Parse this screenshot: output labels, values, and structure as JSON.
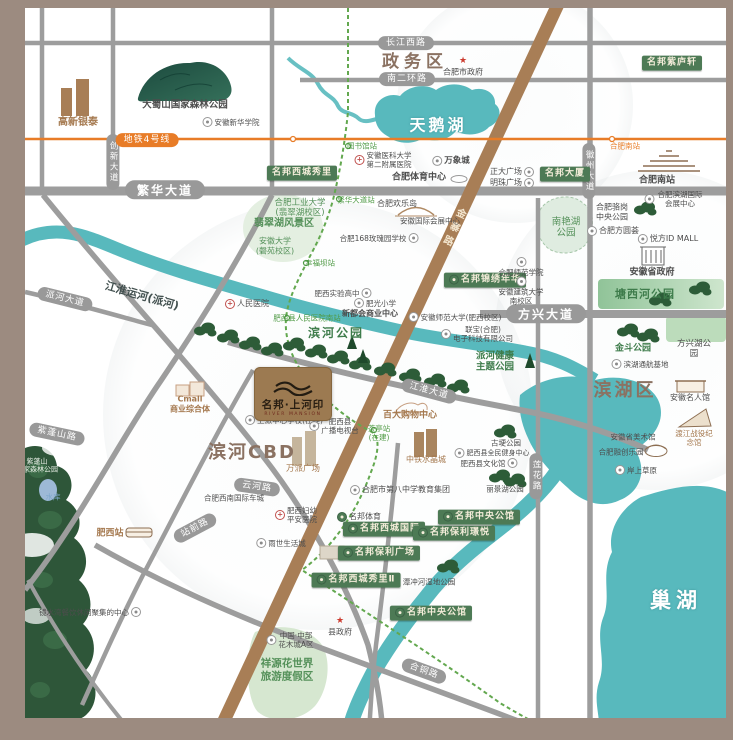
{
  "logo": {
    "title": "名邦·上河印",
    "subtitle": "RIVER MANSION"
  },
  "colors": {
    "frame": "#9c8b80",
    "water": "#58b9bd",
    "badge_green": "#4d7a55",
    "road_gray": "#9d9d9d",
    "road_brown": "#a87e56",
    "metro_line4_orange": "#e87c27",
    "metro_green_dashed": "#63a84f",
    "district_text": "#8b7262",
    "park_green": "#3e7c4b"
  },
  "labels": [
    {
      "name": "district-zhengwuqu",
      "text": "政务区",
      "x": 415,
      "y": 62,
      "cls": "district",
      "fs": 17,
      "ls": 5
    },
    {
      "name": "lake-label-tianehu",
      "text": "天鹅湖",
      "x": 438,
      "y": 125,
      "cls": "lake-big",
      "fs": 16,
      "ls": 3
    },
    {
      "name": "district-binhe-cbd",
      "text": "滨河CBD",
      "x": 252,
      "y": 453,
      "cls": "district",
      "fs": 18,
      "ls": 2
    },
    {
      "name": "district-binhuqu",
      "text": "滨湖区",
      "x": 625,
      "y": 391,
      "cls": "district",
      "fs": 18,
      "ls": 3
    },
    {
      "name": "lake-label-chaohu",
      "text": "巢湖",
      "x": 676,
      "y": 601,
      "cls": "lake-big",
      "fs": 21,
      "ls": 5
    },
    {
      "name": "road-changjiang-west-road",
      "text": "长江西路",
      "x": 406,
      "y": 43,
      "cls": "pill"
    },
    {
      "name": "road-nanerhuan-road",
      "text": "南二环路",
      "x": 407,
      "y": 79,
      "cls": "pill"
    },
    {
      "name": "road-fanhua-avenue",
      "text": "繁华大道",
      "x": 165,
      "y": 190,
      "cls": "pill pill-lg"
    },
    {
      "name": "road-paihe-avenue",
      "text": "派河大道",
      "x": 65,
      "y": 299,
      "cls": "pill",
      "rot": 14
    },
    {
      "name": "road-fangxing-avenue",
      "text": "方兴大道",
      "x": 546,
      "y": 314,
      "cls": "pill pill-lg"
    },
    {
      "name": "road-jianghuai-avenue",
      "text": "江淮大道",
      "x": 429,
      "y": 391,
      "cls": "pill",
      "rot": 15
    },
    {
      "name": "road-zipengshan-road",
      "text": "紫蓬山路",
      "x": 57,
      "y": 434,
      "cls": "pill",
      "rot": 12
    },
    {
      "name": "road-yunhe-road",
      "text": "云河路",
      "x": 257,
      "y": 487,
      "cls": "pill",
      "rot": 8
    },
    {
      "name": "road-hetong-road",
      "text": "合铜路",
      "x": 424,
      "y": 671,
      "cls": "pill",
      "rot": 20
    },
    {
      "name": "road-lianhua-road",
      "text": "莲花路",
      "x": 536,
      "y": 476,
      "cls": "pill vpill"
    },
    {
      "name": "road-huizhou-avenue",
      "text": "徽州大道",
      "x": 589,
      "y": 171,
      "cls": "pill vpill"
    },
    {
      "name": "road-chuangxin-avenue",
      "text": "创新大道",
      "x": 113,
      "y": 162,
      "cls": "pill vpill"
    },
    {
      "name": "road-zhanqian-road",
      "text": "站前路",
      "x": 195,
      "y": 528,
      "cls": "pill",
      "rot": -28
    },
    {
      "name": "road-jinzhai-road",
      "text": "金寨路",
      "x": 452,
      "y": 228,
      "cls": "jinzhai",
      "fs": 10,
      "rot": 25
    },
    {
      "name": "metro-line4-label",
      "text": "地铁4号线",
      "x": 147,
      "y": 140,
      "cls": "pill opill"
    },
    {
      "name": "metro-station-hefeinan",
      "text": "合肥南站",
      "x": 625,
      "y": 146,
      "cls": "ostation"
    },
    {
      "name": "metro-station-tushuguan",
      "text": "图书馆站",
      "x": 362,
      "y": 146,
      "cls": "gstation"
    },
    {
      "name": "metro-station-fanhua-dadao",
      "text": "繁华大道站",
      "x": 356,
      "y": 200,
      "cls": "gstation"
    },
    {
      "name": "metro-station-xingfuba",
      "text": "幸福坝站",
      "x": 320,
      "y": 263,
      "cls": "gstation"
    },
    {
      "name": "metro-station-renmin-hospital-south",
      "text": "肥西县人民医院南站",
      "x": 307,
      "y": 318,
      "cls": "gstation"
    },
    {
      "name": "metro-station-chating",
      "text": "茶亭站\n(在建)",
      "x": 379,
      "y": 433,
      "cls": "gstation"
    },
    {
      "name": "badge-mingbang-xicheng-xiuli",
      "text": "名邦西城秀里",
      "x": 302,
      "y": 173,
      "cls": "badge"
    },
    {
      "name": "badge-mingbang-dasha",
      "text": "名邦大厦",
      "x": 565,
      "y": 174,
      "cls": "badge"
    },
    {
      "name": "badge-mingbang-ziluxuan",
      "text": "名邦紫庐轩",
      "x": 672,
      "y": 63,
      "cls": "badge"
    },
    {
      "name": "badge-mingbang-jinxiu-nianhua",
      "text": "名邦锦绣年华",
      "x": 485,
      "y": 280,
      "cls": "badge",
      "icon": "brand"
    },
    {
      "name": "badge-mingbang-xicheng-guoji",
      "text": "名邦西城国际",
      "x": 384,
      "y": 529,
      "cls": "badge",
      "icon": "brand"
    },
    {
      "name": "badge-mingbang-baoli-jingyue",
      "text": "名邦保利璟悦",
      "x": 454,
      "y": 533,
      "cls": "badge",
      "icon": "brand"
    },
    {
      "name": "badge-mingbang-baoli-guangchang",
      "text": "名邦保利广场",
      "x": 379,
      "y": 553,
      "cls": "badge",
      "icon": "brand"
    },
    {
      "name": "badge-mingbang-zhongyang-gongguan-1",
      "text": "名邦中央公馆",
      "x": 479,
      "y": 517,
      "cls": "badge",
      "icon": "brand"
    },
    {
      "name": "badge-mingbang-xicheng-xiuli-2",
      "text": "名邦西城秀里Ⅱ",
      "x": 356,
      "y": 580,
      "cls": "badge",
      "icon": "brand"
    },
    {
      "name": "badge-mingbang-zhongyang-gongguan-2",
      "text": "名邦中央公馆",
      "x": 431,
      "y": 613,
      "cls": "badge",
      "icon": "brand"
    },
    {
      "name": "poi-dashushan-forest-park",
      "text": "大蜀山国家森林公园",
      "x": 185,
      "y": 105,
      "cls": "dark strong",
      "fs": 9.5
    },
    {
      "name": "poi-xinhua-college",
      "text": "安徽新华学院",
      "x": 231,
      "y": 122,
      "cls": "dark",
      "fs": 7.5,
      "icon": "school"
    },
    {
      "name": "poi-gaoxin-yintai",
      "text": "高新银泰",
      "x": 78,
      "y": 123,
      "cls": "brown strong",
      "fs": 10
    },
    {
      "name": "poi-hefei-city-gov",
      "text": "合肥市政府",
      "x": 463,
      "y": 67,
      "cls": "dark",
      "fs": 8,
      "icon": "gov",
      "icon_side": "top"
    },
    {
      "name": "poi-anyi-second-hospital",
      "text": "安徽医科大学\n第二附属医院",
      "x": 383,
      "y": 160,
      "cls": "dark",
      "fs": 7.5,
      "icon": "hospital"
    },
    {
      "name": "poi-wanxiangcheng",
      "text": "万象城",
      "x": 451,
      "y": 161,
      "cls": "dark strong",
      "fs": 8.5,
      "icon": "shop"
    },
    {
      "name": "poi-hefei-sports-center",
      "text": "合肥体育中心",
      "x": 419,
      "y": 178,
      "cls": "dark strong",
      "fs": 9
    },
    {
      "name": "poi-zhengda-plaza",
      "text": "正大广场",
      "x": 512,
      "y": 172,
      "cls": "dark",
      "fs": 8,
      "icon": "shop",
      "icon_side": "right"
    },
    {
      "name": "poi-mingzhu-plaza",
      "text": "明珠广场",
      "x": 512,
      "y": 183,
      "cls": "dark",
      "fs": 8,
      "icon": "shop",
      "icon_side": "right"
    },
    {
      "name": "poi-hefei-huanledao",
      "text": "合肥欢乐岛",
      "x": 397,
      "y": 204,
      "cls": "dark",
      "fs": 8
    },
    {
      "name": "poi-anhui-intl-expo-center",
      "text": "安徽国际会展中心",
      "x": 430,
      "y": 221,
      "cls": "dark",
      "fs": 7.5
    },
    {
      "name": "poi-168-rose-school",
      "text": "合肥168玫瑰园学校",
      "x": 379,
      "y": 238,
      "cls": "dark",
      "fs": 7.5,
      "icon": "school",
      "icon_side": "right"
    },
    {
      "name": "poi-hefei-univ-technology",
      "text": "合肥工业大学\n(翡翠湖校区)",
      "x": 300,
      "y": 208,
      "cls": "green",
      "fs": 8.5
    },
    {
      "name": "poi-feicuihu-scenic",
      "text": "翡翠湖风景区",
      "x": 284,
      "y": 224,
      "cls": "green strong",
      "fs": 10
    },
    {
      "name": "poi-anhui-university",
      "text": "安徽大学\n(磬苑校区)",
      "x": 275,
      "y": 246,
      "cls": "green",
      "fs": 8
    },
    {
      "name": "poi-renmin-hospital",
      "text": "人民医院",
      "x": 247,
      "y": 304,
      "cls": "dark",
      "fs": 8,
      "icon": "hospital"
    },
    {
      "name": "poi-feixi-shiyan-high-school",
      "text": "肥西实验高中",
      "x": 343,
      "y": 293,
      "cls": "dark",
      "fs": 7.5,
      "icon": "school",
      "icon_side": "right"
    },
    {
      "name": "poi-feiguang-primary-school",
      "text": "肥光小学",
      "x": 375,
      "y": 303,
      "cls": "dark",
      "fs": 7.5,
      "icon": "school"
    },
    {
      "name": "poi-xinduhui-commercial-center",
      "text": "新都会商业中心",
      "x": 370,
      "y": 314,
      "cls": "dark strong",
      "fs": 8
    },
    {
      "name": "poi-binhe-park",
      "text": "滨河公园",
      "x": 336,
      "y": 333,
      "cls": "park",
      "fs": 12,
      "ls": 2
    },
    {
      "name": "poi-anhui-normal-university",
      "text": "安徽师范大学(肥西校区)",
      "x": 455,
      "y": 317,
      "cls": "dark",
      "fs": 7.5,
      "icon": "school"
    },
    {
      "name": "poi-lianbao-electronics",
      "text": "联宝(合肥)\n电子科技有限公司",
      "x": 477,
      "y": 334,
      "cls": "dark",
      "fs": 7.5,
      "icon": "shop"
    },
    {
      "name": "river-label-jianghuai-canal",
      "text": "江淮运河(派河)",
      "x": 142,
      "y": 296,
      "cls": "canal",
      "fs": 11,
      "rot": 16
    },
    {
      "name": "poi-paihe-health-theme-park",
      "text": "派河健康\n主题公园",
      "x": 495,
      "y": 362,
      "cls": "park",
      "fs": 9.5
    },
    {
      "name": "poi-nanyanhu-park",
      "text": "南艳湖\n公园",
      "x": 566,
      "y": 228,
      "cls": "green",
      "fs": 9.5
    },
    {
      "name": "poi-luogang-central-park",
      "text": "合肥骆岗\n中央公园",
      "x": 612,
      "y": 212,
      "cls": "dark",
      "fs": 8
    },
    {
      "name": "poi-binhu-intl-expo-center",
      "text": "合肥滨湖国际会展中心",
      "x": 674,
      "y": 199,
      "cls": "dark",
      "fs": 7.5,
      "icon": "shop"
    },
    {
      "name": "poi-fangyuanhui",
      "text": "合肥方圆荟",
      "x": 613,
      "y": 231,
      "cls": "dark",
      "fs": 8,
      "icon": "shop"
    },
    {
      "name": "poi-yuefang-id-mall",
      "text": "悦方ID MALL",
      "x": 668,
      "y": 239,
      "cls": "dark",
      "fs": 8,
      "icon": "shop"
    },
    {
      "name": "poi-anhui-provincial-gov",
      "text": "安徽省政府",
      "x": 652,
      "y": 273,
      "cls": "dark strong",
      "fs": 9
    },
    {
      "name": "poi-tangxihe-park",
      "text": "塘西河公园",
      "x": 645,
      "y": 294,
      "cls": "park",
      "fs": 11,
      "ls": 1
    },
    {
      "name": "poi-hefei-normal-college",
      "text": "合肥师范学院",
      "x": 521,
      "y": 267,
      "cls": "dark",
      "fs": 7.5,
      "icon": "school",
      "icon_side": "top"
    },
    {
      "name": "poi-anhui-jianzhu-university",
      "text": "安徽建筑大学\n南校区",
      "x": 521,
      "y": 291,
      "cls": "dark",
      "fs": 7.5,
      "icon": "school",
      "icon_side": "top"
    },
    {
      "name": "poi-jindou-park",
      "text": "金斗公园",
      "x": 633,
      "y": 349,
      "cls": "park",
      "fs": 9
    },
    {
      "name": "poi-fangxinghu-park",
      "text": "方兴湖公园",
      "x": 694,
      "y": 349,
      "cls": "dark",
      "fs": 8.5
    },
    {
      "name": "poi-binhu-tonghang-base",
      "text": "滨湖通航基地",
      "x": 640,
      "y": 364,
      "cls": "dark",
      "fs": 7.5,
      "icon": "shop"
    },
    {
      "name": "poi-anhui-mingren-hall",
      "text": "安徽名人馆",
      "x": 690,
      "y": 398,
      "cls": "dark",
      "fs": 8
    },
    {
      "name": "poi-anhui-art-museum",
      "text": "安徽省美术馆",
      "x": 633,
      "y": 437,
      "cls": "dark",
      "fs": 7.5
    },
    {
      "name": "poi-dujiang-memorial",
      "text": "渡江战役纪念馆",
      "x": 694,
      "y": 438,
      "cls": "brown",
      "fs": 7.5
    },
    {
      "name": "poi-rongchuang-leyuan",
      "text": "合肥融创乐园",
      "x": 621,
      "y": 452,
      "cls": "dark",
      "fs": 7.5
    },
    {
      "name": "poi-anshang-caoyuan",
      "text": "岸上草原",
      "x": 636,
      "y": 470,
      "cls": "dark",
      "fs": 7.5,
      "icon": "shop"
    },
    {
      "name": "poi-gugeng-park",
      "text": "古埂公园",
      "x": 506,
      "y": 443,
      "cls": "dark",
      "fs": 7.5
    },
    {
      "name": "poi-feixi-fitness-center",
      "text": "肥西县全民健身中心",
      "x": 492,
      "y": 453,
      "cls": "dark",
      "fs": 7,
      "icon": "shop"
    },
    {
      "name": "poi-feixi-culture-hall",
      "text": "肥西县文化馆",
      "x": 489,
      "y": 463,
      "cls": "dark",
      "fs": 7.5,
      "icon": "shop",
      "icon_side": "right"
    },
    {
      "name": "poi-lijinghu-park",
      "text": "丽景湖公园",
      "x": 505,
      "y": 489,
      "cls": "dark",
      "fs": 7.5
    },
    {
      "name": "poi-no8-middle-school-group",
      "text": "合肥市第八中学教育集团",
      "x": 400,
      "y": 490,
      "cls": "dark",
      "fs": 8,
      "icon": "school"
    },
    {
      "name": "poi-mingbang-sports",
      "text": "名邦体育",
      "x": 359,
      "y": 517,
      "cls": "dark",
      "fs": 8,
      "icon": "brand"
    },
    {
      "name": "poi-fuyou-pingan-hospital",
      "text": "肥西妇幼\n平安医院",
      "x": 296,
      "y": 515,
      "cls": "dark",
      "fs": 7.5,
      "icon": "hospital"
    },
    {
      "name": "poi-yushi-life-city",
      "text": "雨世生活城",
      "x": 281,
      "y": 543,
      "cls": "dark",
      "fs": 7.5,
      "icon": "shop"
    },
    {
      "name": "poi-southwest-intl-auto-city",
      "text": "合肥西南国际车城",
      "x": 234,
      "y": 498,
      "cls": "dark",
      "fs": 7.5
    },
    {
      "name": "poi-shangpai-central-school",
      "text": "上派中心学校(在建)",
      "x": 284,
      "y": 420,
      "cls": "dark",
      "fs": 7.5,
      "icon": "school"
    },
    {
      "name": "poi-feixi-tv-station",
      "text": "肥西县\n广播电视台",
      "x": 334,
      "y": 426,
      "cls": "dark",
      "fs": 7.5,
      "icon": "shop"
    },
    {
      "name": "poi-baida-shopping-center",
      "text": "百大购物中心",
      "x": 410,
      "y": 416,
      "cls": "brown strong",
      "fs": 9
    },
    {
      "name": "poi-zhongtie-crystal-city",
      "text": "中铁水晶城",
      "x": 426,
      "y": 460,
      "cls": "brown",
      "fs": 8
    },
    {
      "name": "poi-wanpai-plaza",
      "text": "万派广场",
      "x": 303,
      "y": 469,
      "cls": "brown",
      "fs": 8.5
    },
    {
      "name": "poi-cmall-complex",
      "text": "Cmall\n商业综合体",
      "x": 190,
      "y": 404,
      "cls": "brown strong",
      "fs": 8
    },
    {
      "name": "poi-feixi-railway-station",
      "text": "肥西站",
      "x": 110,
      "y": 534,
      "cls": "brown strong",
      "fs": 9
    },
    {
      "name": "poi-hefeinan-railway-station",
      "text": "合肥南站",
      "x": 657,
      "y": 181,
      "cls": "dark strong",
      "fs": 9
    },
    {
      "name": "poi-zipengshan-forest-park",
      "text": "紫蓬山\n国家森林公园",
      "x": 37,
      "y": 466,
      "cls": "forest",
      "fs": 7
    },
    {
      "name": "poi-reservoir",
      "text": "水库",
      "x": 53,
      "y": 497,
      "cls": "water-small",
      "fs": 7.5
    },
    {
      "name": "poi-county-gov",
      "text": "县政府",
      "x": 340,
      "y": 627,
      "cls": "dark",
      "fs": 8,
      "icon": "gov",
      "icon_side": "top"
    },
    {
      "name": "poi-huamucheng-a",
      "text": "中国·中部\n花木城A区",
      "x": 290,
      "y": 640,
      "cls": "dark",
      "fs": 7.5,
      "icon": "shop"
    },
    {
      "name": "poi-xiangyuan-flower-world",
      "text": "祥源花世界\n旅游度假区",
      "x": 287,
      "y": 670,
      "cls": "green strong",
      "fs": 10.5
    },
    {
      "name": "poi-tanchonghe-wetland-park",
      "text": "潭冲河湿地公园",
      "x": 429,
      "y": 582,
      "cls": "dark",
      "fs": 7.5
    },
    {
      "name": "poi-jingshuiwan-dining-center",
      "text": "镜水湾餐饮休闲聚集的中心",
      "x": 90,
      "y": 612,
      "cls": "dark",
      "fs": 7.5,
      "icon": "shop",
      "icon_side": "right"
    }
  ]
}
